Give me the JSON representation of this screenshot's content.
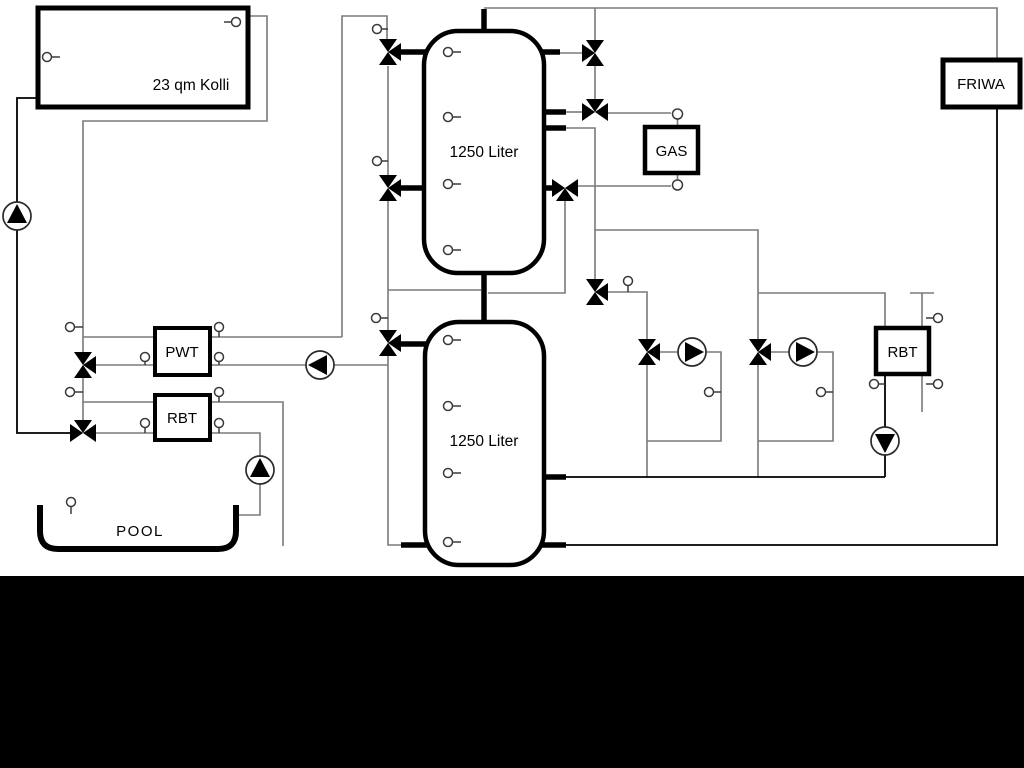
{
  "diagram": {
    "labels": {
      "collector": "23 qm Kolli",
      "tank_top": "1250 Liter",
      "tank_bottom": "1250 Liter",
      "pwt": "PWT",
      "rbt_left": "RBT",
      "rbt_right": "RBT",
      "gas": "GAS",
      "friwa": "FRIWA",
      "pool": "POOL"
    },
    "colors": {
      "pipe_gray": "#7a7a7a",
      "line_black": "#000000",
      "background": "#ffffff",
      "bottom_band": "#000000"
    }
  }
}
